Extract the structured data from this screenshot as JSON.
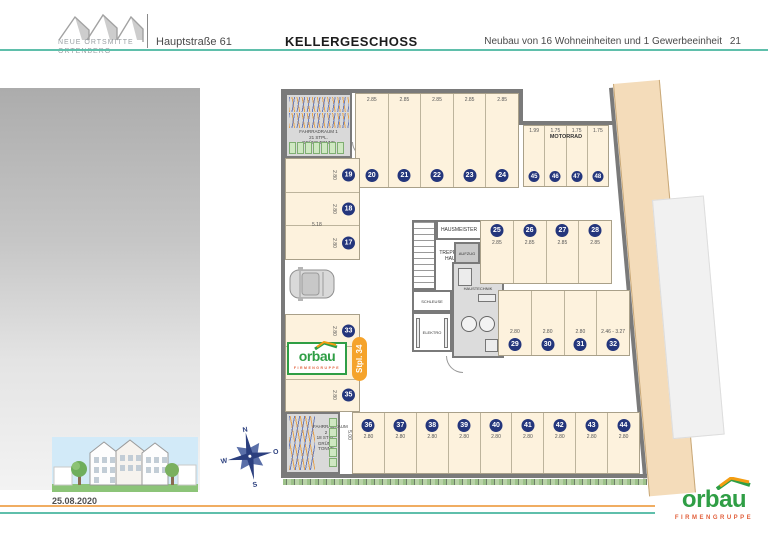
{
  "header": {
    "logo_line1": "NEUE ORTSMITTE",
    "logo_line2": "ORTENBERG",
    "address": "Hauptstraße 61",
    "title": "KELLERGESCHOSS",
    "subtitle": "Neubau von 16 Wohneinheiten und 1 Gewerbeeinheit",
    "page_number": "21"
  },
  "left_panel": {
    "date": "25.08.2020"
  },
  "compass": {
    "north": "N",
    "east": "O",
    "south": "S",
    "west": "W"
  },
  "brand": {
    "name": "orbau",
    "subtitle": "FIRMENGRUPPE",
    "green": "#2f9e45",
    "roof_orange": "#f49d12",
    "sub_red": "#e2603c"
  },
  "plan": {
    "tag_stall34": "Stpl. 34",
    "rooms": {
      "fahrradraum1": {
        "line1": "FAHRRADRAUM 1",
        "line2": "21 STPL.",
        "line3": "GRÜNE TONNE"
      },
      "fahrradraum2": {
        "line1": "FAHRRADRAUM 2",
        "line2": "18 STPL.",
        "line3": "GRÜNE TONNE"
      },
      "hausmeister": "HAUSMEISTER",
      "treppenhaus_line1": "TREPPEN-",
      "treppenhaus_line2": "HAUS",
      "aufzug": "AUFZUG",
      "schleuse": "SCHLEUSE",
      "elektro": "ELEKTRO",
      "haustechnik": "HAUSTECHNIK",
      "motorrad": "MOTORRAD"
    },
    "dims": {
      "left_width": "5.18",
      "bottom_depth": "5.00"
    },
    "rows": {
      "top": [
        {
          "no": "20",
          "dim": "2.85"
        },
        {
          "no": "21",
          "dim": "2.85"
        },
        {
          "no": "22",
          "dim": "2.85"
        },
        {
          "no": "23",
          "dim": "2.85"
        },
        {
          "no": "24",
          "dim": "2.85"
        }
      ],
      "moto": [
        {
          "no": "45",
          "dim": "1.99"
        },
        {
          "no": "46",
          "dim": "1.75"
        },
        {
          "no": "47",
          "dim": "1.75"
        },
        {
          "no": "48",
          "dim": "1.75"
        }
      ],
      "left": [
        {
          "no": "19",
          "dim": "2.80"
        },
        {
          "no": "18",
          "dim": "2.80"
        },
        {
          "no": "17",
          "dim": "2.80"
        }
      ],
      "midleft": [
        {
          "no": "33",
          "dim": "2.80"
        },
        {},
        {
          "no": "35",
          "dim": "2.80"
        }
      ],
      "upper": [
        {
          "no": "25",
          "dim": "2.85"
        },
        {
          "no": "26",
          "dim": "2.85"
        },
        {
          "no": "27",
          "dim": "2.85"
        },
        {
          "no": "28",
          "dim": "2.85"
        }
      ],
      "lower": [
        {
          "no": "29",
          "dim": "2.80"
        },
        {
          "no": "30",
          "dim": "2.80"
        },
        {
          "no": "31",
          "dim": "2.80"
        },
        {
          "no": "32",
          "dim": "2.46 - 3.27"
        }
      ],
      "bottom": [
        {
          "no": "36",
          "dim": "2.80"
        },
        {
          "no": "37",
          "dim": "2.80"
        },
        {
          "no": "38",
          "dim": "2.80"
        },
        {
          "no": "39",
          "dim": "2.80"
        },
        {
          "no": "40",
          "dim": "2.80"
        },
        {
          "no": "41",
          "dim": "2.80"
        },
        {
          "no": "42",
          "dim": "2.80"
        },
        {
          "no": "43",
          "dim": "2.80"
        },
        {
          "no": "44",
          "dim": "2.80"
        }
      ]
    },
    "colors": {
      "stall_fill": "#fdf2dd",
      "wall_gray": "#7a7a7a",
      "badge_navy": "#24367c",
      "tag_orange": "#f5a32b",
      "teal_line": "#5fbfab",
      "orange_line": "#f0ad62",
      "neighbor_beige": "#f4dcba"
    }
  }
}
